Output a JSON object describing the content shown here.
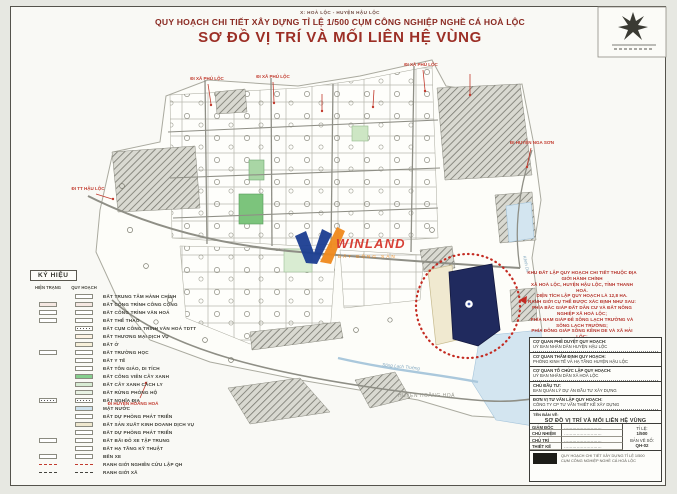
{
  "header": {
    "location": "X: HOÀ LỘC - HUYỆN HẬU LỘC",
    "subtitle": "QUY HOẠCH CHI TIẾT XÂY DỰNG TỈ LỆ 1/500 CỤM CÔNG NGHIỆP NGHỀ CÁ HOÀ LỘC",
    "title": "SƠ ĐỒ VỊ TRÍ VÀ MỐI LIÊN HỆ VÙNG"
  },
  "watermark": {
    "brand": "WINLAND",
    "sub": "BẤT ĐỘNG SẢN"
  },
  "legend": {
    "title": "KÝ HIỆU",
    "columns": [
      "HIỆN TRẠNG",
      "QUY HOẠCH"
    ],
    "items": [
      {
        "label": "ĐẤT TRUNG TÂM HÀNH CHÍNH",
        "kind": "box",
        "fill": "#ffffff",
        "left": false
      },
      {
        "label": "ĐẤT CÔNG TRÌNH CÔNG CỘNG",
        "kind": "box",
        "fill": "#f5e8e2",
        "left": true
      },
      {
        "label": "ĐẤT CÔNG TRÌNH VĂN HOÁ",
        "kind": "box",
        "fill": "#ffffff",
        "left": true
      },
      {
        "label": "ĐẤT THỂ THAO",
        "kind": "box",
        "fill": "#ffffff",
        "left": true
      },
      {
        "label": "ĐẤT CỤM CÔNG TRÌNH VĂN HOÁ TDTT",
        "kind": "dots",
        "fill": "#ffffff",
        "left": false
      },
      {
        "label": "ĐẤT THƯƠNG MẠI DỊCH VỤ",
        "kind": "box",
        "fill": "#fdf3e4",
        "left": false
      },
      {
        "label": "ĐẤT Ở",
        "kind": "box",
        "fill": "#f7f0da",
        "left": false
      },
      {
        "label": "ĐẤT TRƯỜNG HỌC",
        "kind": "box",
        "fill": "#ffffff",
        "left": true
      },
      {
        "label": "ĐẤT Y TẾ",
        "kind": "box",
        "fill": "#ffffff",
        "left": false
      },
      {
        "label": "ĐẤT TÔN GIÁO, DI TÍCH",
        "kind": "box",
        "fill": "#ffffff",
        "left": false
      },
      {
        "label": "ĐẤT CÔNG VIÊN CÂY XANH",
        "kind": "box",
        "fill": "#86cf8e",
        "left": false
      },
      {
        "label": "ĐẤT CÂY XANH CÁCH LY",
        "kind": "box",
        "fill": "#d8ecd4",
        "left": false
      },
      {
        "label": "ĐẤT RỪNG PHÒNG HỘ",
        "kind": "box",
        "fill": "#e8f2e4",
        "left": false
      },
      {
        "label": "ĐẤT NGHĨA ĐỊA",
        "kind": "dots",
        "fill": "#ffffff",
        "left": true
      },
      {
        "label": "MẶT NƯỚC",
        "kind": "box",
        "fill": "#cfe2ee",
        "left": false
      },
      {
        "label": "ĐẤT DỰ PHÒNG PHÁT TRIỂN",
        "kind": "box",
        "fill": "#ffffff",
        "left": false
      },
      {
        "label": "ĐẤT SẢN XUẤT KINH DOANH DỊCH VỤ",
        "kind": "box",
        "fill": "#efe8cf",
        "left": false
      },
      {
        "label": "ĐẤT DỰ PHÒNG PHÁT TRIỂN",
        "kind": "box",
        "fill": "#ffffff",
        "left": false
      },
      {
        "label": "ĐẤT BÃI ĐỖ XE TẬP TRUNG",
        "kind": "box",
        "fill": "#ffffff",
        "left": true
      },
      {
        "label": "ĐẤT HẠ TẦNG KỸ THUẬT",
        "kind": "box",
        "fill": "#ffffff",
        "left": false
      },
      {
        "label": "BẾN XE",
        "kind": "box",
        "fill": "#ffffff",
        "left": true
      },
      {
        "label": "RANH GIỚI NGHIÊN CỨU LẬP QH",
        "kind": "line-dashed",
        "fill": "#ffffff",
        "left": true
      },
      {
        "label": "RANH GIỚI XÃ",
        "kind": "line-dashdot",
        "fill": "#ffffff",
        "left": true
      }
    ]
  },
  "map": {
    "labels": {
      "district_south": "HUYỆN HOẰNG HOÁ",
      "river": "Sông Lạch Trường",
      "canal": "Kênh De"
    },
    "pins": [
      {
        "label": "ĐI XÃ PHÚ LỘC"
      },
      {
        "label": "ĐI XÃ PHÚ LỘC"
      },
      {
        "label": "ĐI XÃ PHÚ LỘC"
      },
      {
        "label": "ĐI HUYỆN NGA SƠN"
      },
      {
        "label": "ĐI TT HẬU LỘC"
      },
      {
        "label": "ĐI HUYỆN HOẰNG HOÁ"
      }
    ]
  },
  "callout": {
    "lines": [
      "KHU ĐẤT LẬP QUY HOẠCH CHI TIẾT THUỘC ĐỊA GIỚI HÀNH CHÍNH",
      "XÃ HOÀ LỘC, HUYỆN HẬU LỘC, TỈNH THANH HOÁ.",
      "DIỆN TÍCH LẬP QUY HOẠCH LÀ 12,8 HA.",
      "RANH GIỚI CỤ THỂ ĐƯỢC XÁC ĐỊNH NHƯ SAU:",
      "PHÍA BẮC GIÁP ĐẤT DÂN CƯ VÀ ĐẤT NÔNG NGHIỆP XÃ HOÀ LỘC;",
      "PHÍA NAM GIÁP ĐÊ SÔNG LẠCH TRƯỜNG VÀ SÔNG LẠCH TRƯỜNG;",
      "PHÍA ĐÔNG GIÁP SÔNG KÊNH DE VÀ XÃ HẢI LỘC;",
      "PHÍA TÂY GIÁP ĐẤT DÂN CƯ HIỆN TRẠNG XÃ HOÀ LỘC."
    ]
  },
  "titleblock": {
    "sections": [
      {
        "caption": "CƠ QUAN PHÊ DUYỆT QUY HOẠCH:",
        "body": "UỶ BAN NHÂN DÂN HUYỆN HẬU LỘC"
      },
      {
        "caption": "CƠ QUAN THẨM ĐỊNH QUY HOẠCH:",
        "body": "PHÒNG KINH TẾ VÀ HẠ TẦNG HUYỆN HẬU LỘC"
      },
      {
        "caption": "CƠ QUAN TỔ CHỨC LẬP QUY HOẠCH:",
        "body": "UỶ BAN NHÂN DÂN XÃ HOÀ LỘC"
      },
      {
        "caption": "CHỦ ĐẦU TƯ:",
        "body": "BAN QUẢN LÝ DỰ ÁN ĐẦU TƯ XÂY DỰNG"
      },
      {
        "caption": "ĐƠN VỊ TƯ VẤN LẬP QUY HOẠCH:",
        "body": "CÔNG TY CP TƯ VẤN THIẾT KẾ XÂY DỰNG"
      }
    ],
    "drawing_caption": "TÊN BẢN VẼ:",
    "drawing_name": "SƠ ĐỒ VỊ TRÍ VÀ MỐI LIÊN HỆ VÙNG",
    "roles": [
      {
        "role": "GIÁM ĐỐC",
        "name": "………………………"
      },
      {
        "role": "CHỦ NHIỆM",
        "name": "………………………"
      },
      {
        "role": "CHỦ TRÌ",
        "name": "………………………"
      },
      {
        "role": "THIẾT KẾ",
        "name": "………………………"
      }
    ],
    "scale_label": "TỈ LỆ:",
    "scale_value": "1/500",
    "sheet_label": "BẢN VẼ SỐ:",
    "sheet_value": "QH-02",
    "stamp_lines": [
      "QUY HOẠCH CHI TIẾT XÂY DỰNG TỈ LỆ 1/500",
      "CỤM CÔNG NGHIỆP NGHỀ CÁ HOÀ LỘC"
    ]
  },
  "colors": {
    "accent_red": "#c23b2e",
    "site_navy": "#202a5e",
    "water": "#cfe2ee",
    "park_green": "#86cf8e"
  }
}
